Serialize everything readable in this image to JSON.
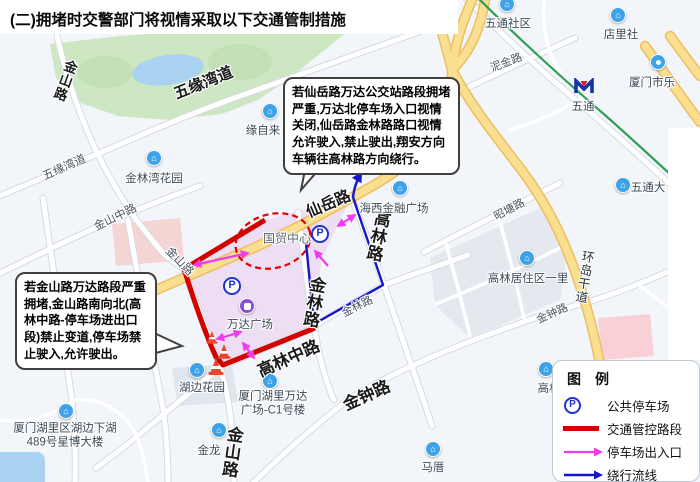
{
  "title": "(二)拥堵时交警部门将视情采取以下交通管制措施",
  "callouts": {
    "xianyue": "若仙岳路万达公交站路段拥堵严重,万达北停车场入口视情关闭,仙岳路金林路路口视情允许驶入,禁止驶出,翔安方向车辆往高林路方向绕行。",
    "jinshan": "若金山路万达路段严重拥堵,金山路南向北(高林中路-停车场进出口段)禁止变道,停车场禁止驶入,允许驶出。"
  },
  "legend": {
    "title": "图　例",
    "items": [
      {
        "icon": "parking-sign-icon",
        "label": "公共停车场"
      },
      {
        "icon": "control-route-sample",
        "label": "交通管控路段"
      },
      {
        "icon": "parking-arrow-sample",
        "label": "停车场出入口"
      },
      {
        "icon": "detour-arrow-sample",
        "label": "绕行流线"
      }
    ]
  },
  "map": {
    "parking_sign": "P",
    "road_labels": [
      {
        "text": "金山路"
      },
      {
        "text": "五缘湾道"
      },
      {
        "text": "五缘湾道"
      },
      {
        "text": "金山中路"
      },
      {
        "text": "金山路"
      },
      {
        "text": "仙岳路"
      },
      {
        "text": "金林路"
      },
      {
        "text": "金林路"
      },
      {
        "text": "高林路"
      },
      {
        "text": "高林中路"
      },
      {
        "text": "金山路"
      },
      {
        "text": "金钟路"
      },
      {
        "text": "金钟路"
      },
      {
        "text": "昭塘路"
      },
      {
        "text": "泥金路"
      },
      {
        "text": "环岛干道"
      }
    ],
    "poi_labels": [
      {
        "text": "金林湾花园"
      },
      {
        "text": "缘自来"
      },
      {
        "text": "五通社区"
      },
      {
        "text": "店里社"
      },
      {
        "text": "厦门市乐"
      },
      {
        "text": "五通"
      },
      {
        "text": "海西金融广场"
      },
      {
        "text": "高林居住区一里"
      },
      {
        "text": "五通大"
      },
      {
        "text": "国贸中心"
      },
      {
        "text": "万达广场"
      },
      {
        "text": "湖边花园"
      },
      {
        "text": "厦门湖里区湖边下湖489号星博大楼"
      },
      {
        "text": "金龙"
      },
      {
        "text": "厦门湖里万达广场-C1号楼"
      },
      {
        "text": "马厝"
      },
      {
        "text": "高林"
      }
    ]
  },
  "colors": {
    "control_route": "#d40000",
    "parking_arrow": "#ee3cee",
    "detour_line": "#1515cc",
    "highlight_ellipse": "#e60000",
    "parking_sign_blue": "#2033cc",
    "poi_pin_blue": "#3da2e8",
    "wanda_pin_purple": "#8a4fd3",
    "metro_line_green": "#2f9e52",
    "main_road_yellow": "#f9df8f"
  }
}
